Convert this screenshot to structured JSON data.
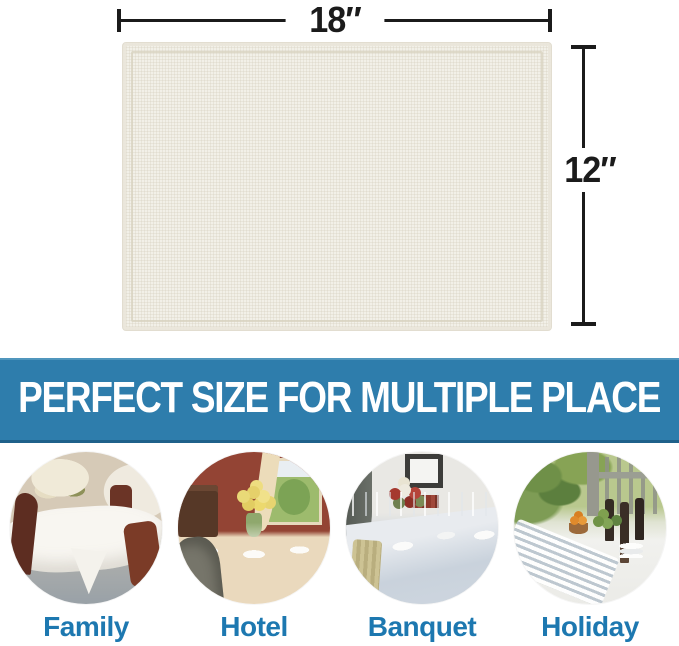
{
  "product_diagram": {
    "width_label": "18″",
    "height_label": "12″",
    "product_description": "cream linen placemat"
  },
  "banner": {
    "title": "PERFECT SIZE FOR MULTIPLE PLACE"
  },
  "use_cases": [
    {
      "label": "Family",
      "photo_description": "family dining room, round table with white tablecloth and mahogany chairs"
    },
    {
      "label": "Hotel",
      "photo_description": "hotel dining table with yellow roses, red wall, window and sideboard"
    },
    {
      "label": "Banquet",
      "photo_description": "banquet long table with pale blue cloth, glasses, plates and flower centerpiece"
    },
    {
      "label": "Holiday",
      "photo_description": "outdoor holiday table with wine bottles, fruit bowl, striped runner and greenery"
    }
  ],
  "colors": {
    "banner_background": "#2e7dac",
    "banner_text": "#ffffff",
    "label_text": "#1d78b0",
    "dimension_lines": "#1b1b1b",
    "placemat_cream": "#f2f0e8"
  }
}
